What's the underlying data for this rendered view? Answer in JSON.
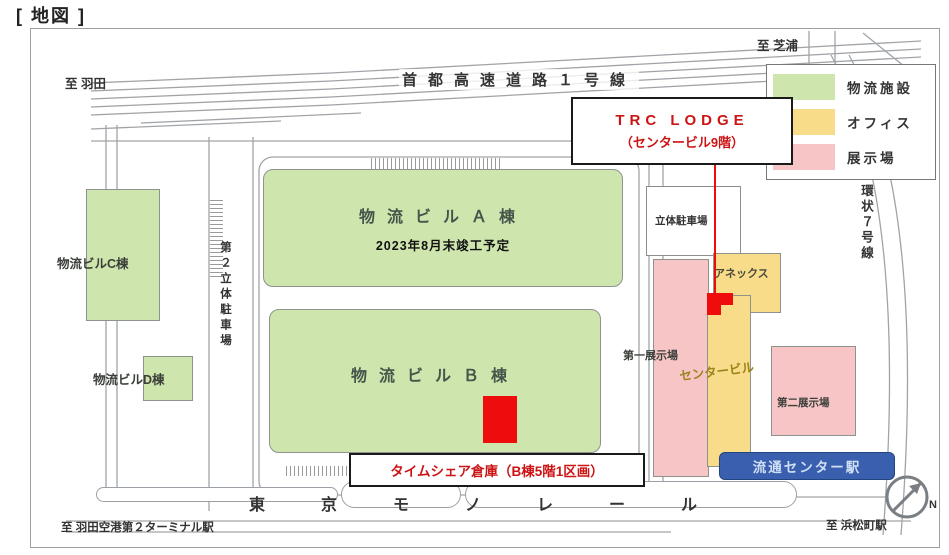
{
  "page": {
    "title": "[ 地図 ]"
  },
  "colors": {
    "logistics_green": "#cfe5ae",
    "office_yellow": "#f8dc8a",
    "exhibition_pink": "#f8c5c7",
    "highlight_red": "#ee0c0c",
    "callout_text_red": "#cc1414",
    "station_blue": "#3a5fae",
    "road_gray": "#a0a4a8"
  },
  "roads": {
    "expressway_label": "首都高速道路１号線",
    "ring_road_label": "環状７号線",
    "monorail_label": "東京モノレール"
  },
  "directions": {
    "to_haneda": "至 羽田",
    "to_shibaura": "至 芝浦",
    "to_hamamatsucho": "至 浜松町駅",
    "to_haneda_terminal2": "至 羽田空港第２ターミナル駅"
  },
  "legend": {
    "items": [
      {
        "label": "物流施設",
        "color": "#cfe5ae"
      },
      {
        "label": "オフィス",
        "color": "#f8dc8a"
      },
      {
        "label": "展示場",
        "color": "#f8c5c7"
      }
    ]
  },
  "buildings": {
    "a": {
      "label": "物流ビルＡ棟",
      "note": "2023年8月末竣工予定"
    },
    "b": {
      "label": "物流ビルＢ棟"
    },
    "c": {
      "label": "物流ビルC棟"
    },
    "d": {
      "label": "物流ビルD棟"
    },
    "parking_no2": {
      "label": "第２立体駐車場"
    },
    "parking": {
      "label": "立体駐車場"
    },
    "annex": {
      "label": "アネックス"
    },
    "center": {
      "label": "センタービル"
    },
    "exhibition1": {
      "label": "第一展示場"
    },
    "exhibition2": {
      "label": "第二展示場"
    }
  },
  "callouts": {
    "trc_lodge": {
      "line1": "TRC LODGE",
      "line2": "（センタービル9階）"
    },
    "timeshare": {
      "label": "タイムシェア倉庫（B棟5階1区画）"
    }
  },
  "station": {
    "label": "流通センター駅"
  },
  "compass": {
    "label": "N"
  }
}
